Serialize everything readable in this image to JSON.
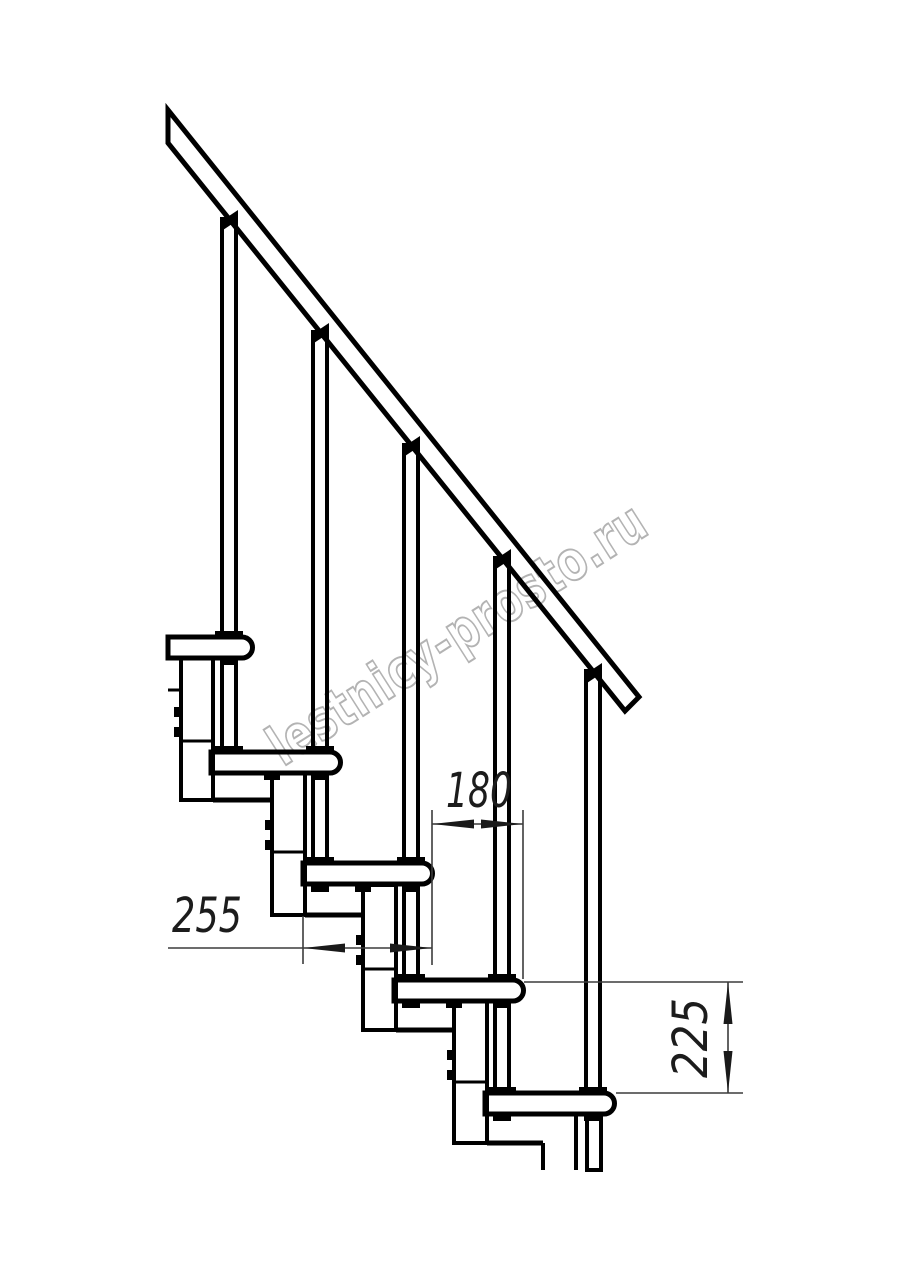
{
  "drawing": {
    "watermark": "lestnicy-prosto.ru",
    "dimensions": {
      "tread_depth": {
        "value": "255",
        "orientation": "horizontal"
      },
      "step_run": {
        "value": "180",
        "orientation": "horizontal"
      },
      "step_rise": {
        "value": "225",
        "orientation": "vertical"
      }
    },
    "structure": {
      "treads_visible": 5,
      "balusters_visible": 5,
      "handrail": "diagonal, squared end"
    },
    "colors": {
      "line": "#000000",
      "dimension": "#3c3c3c",
      "watermark_outline": "#b3b3b3",
      "background": "#ffffff"
    }
  }
}
